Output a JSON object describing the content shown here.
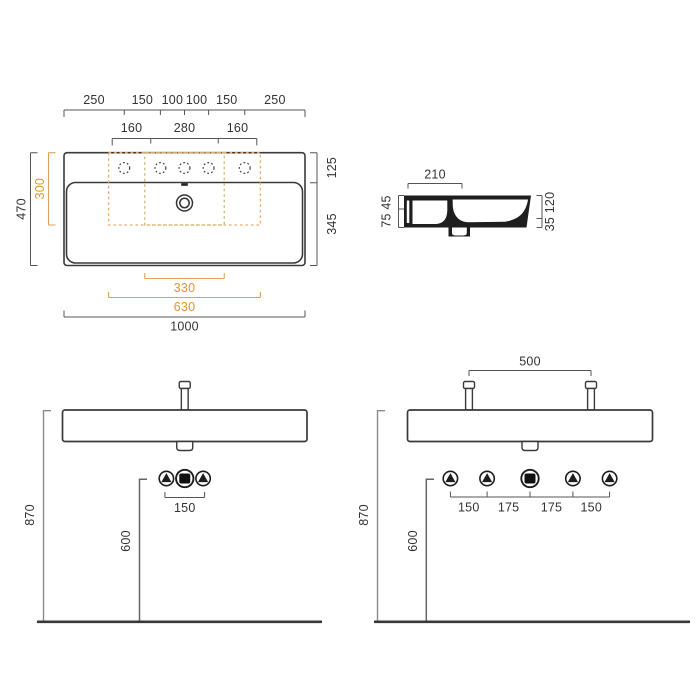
{
  "drawing_title": "wall-hung washbasin technical dimension drawing",
  "colors": {
    "line": "#3a3a3a",
    "dimension_text": "#333333",
    "accent_orange": "#e0952f",
    "dash_orange": "#e8a96a",
    "dash_khaki": "#c9bc72",
    "guide_gray": "#8a8a8a",
    "floor_line": "#383838"
  },
  "plan_view": {
    "hole_spacing_chain": [
      "250",
      "150",
      "100",
      "100",
      "150",
      "250"
    ],
    "hole_group_chain": [
      "160",
      "280",
      "160"
    ],
    "deck_depth": "125",
    "bowl_depth": "345",
    "overall_depth": "470",
    "template_depth": "300",
    "template_width_inner": "330",
    "template_width_outer": "630",
    "overall_width": "1000"
  },
  "side_view": {
    "ledge_width": "210",
    "upper_height": "45",
    "lower_height": "75",
    "overall_height": "120",
    "bottom_height": "35"
  },
  "front_view_single": {
    "rim_height": "870",
    "drain_height": "600",
    "connection_spacing": "150"
  },
  "front_view_double": {
    "tap_spacing": "500",
    "rim_height": "870",
    "drain_height": "600",
    "connection_spacing": [
      "150",
      "175",
      "175",
      "150"
    ]
  },
  "icons": {
    "water_connection": "triangle-in-circle",
    "drain_connection": "square-in-circle",
    "faucet_hole": "dotted-circle",
    "drain_outlet": "double-circle"
  }
}
